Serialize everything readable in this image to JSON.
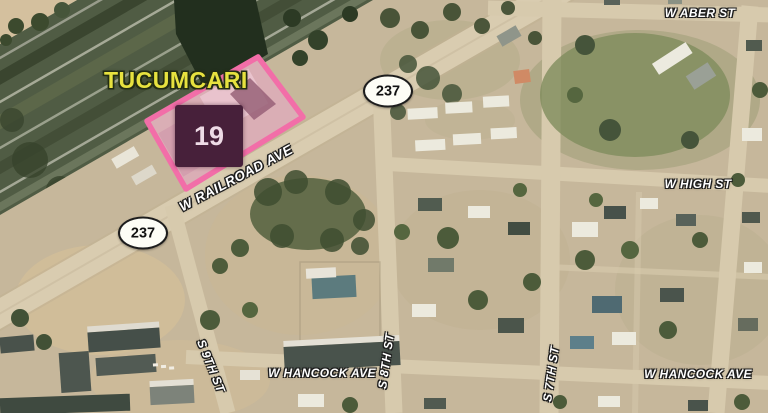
{
  "map": {
    "city_label": "TUCUMCARI",
    "parcel": {
      "number": "19",
      "outline_color": "#f26ea8",
      "fill_color": "rgba(237,166,195,0.38)",
      "marker_bg": "#47203a",
      "marker_text_color": "#eedbe6"
    },
    "highway_shields": [
      {
        "route": "237"
      },
      {
        "route": "237"
      }
    ],
    "street_labels": [
      {
        "id": "w-railroad-ave",
        "name": "W RAILROAD AVE"
      },
      {
        "id": "w-aber-st",
        "name": "W ABER ST"
      },
      {
        "id": "w-high-st",
        "name": "W HIGH ST"
      },
      {
        "id": "w-hancock-ave-left",
        "name": "W HANCOCK AVE"
      },
      {
        "id": "w-hancock-ave-right",
        "name": "W HANCOCK AVE"
      },
      {
        "id": "s-9th-st",
        "name": "S 9TH ST"
      },
      {
        "id": "s-8th-st",
        "name": "S 8TH ST"
      },
      {
        "id": "s-7th-st",
        "name": "S 7TH ST"
      }
    ],
    "colors": {
      "city_label": "#e7e23f",
      "street_label": "#ffffff",
      "terrain": "#c6b79b",
      "road": "#d7caad",
      "railroad_dark": "#505c44"
    }
  }
}
